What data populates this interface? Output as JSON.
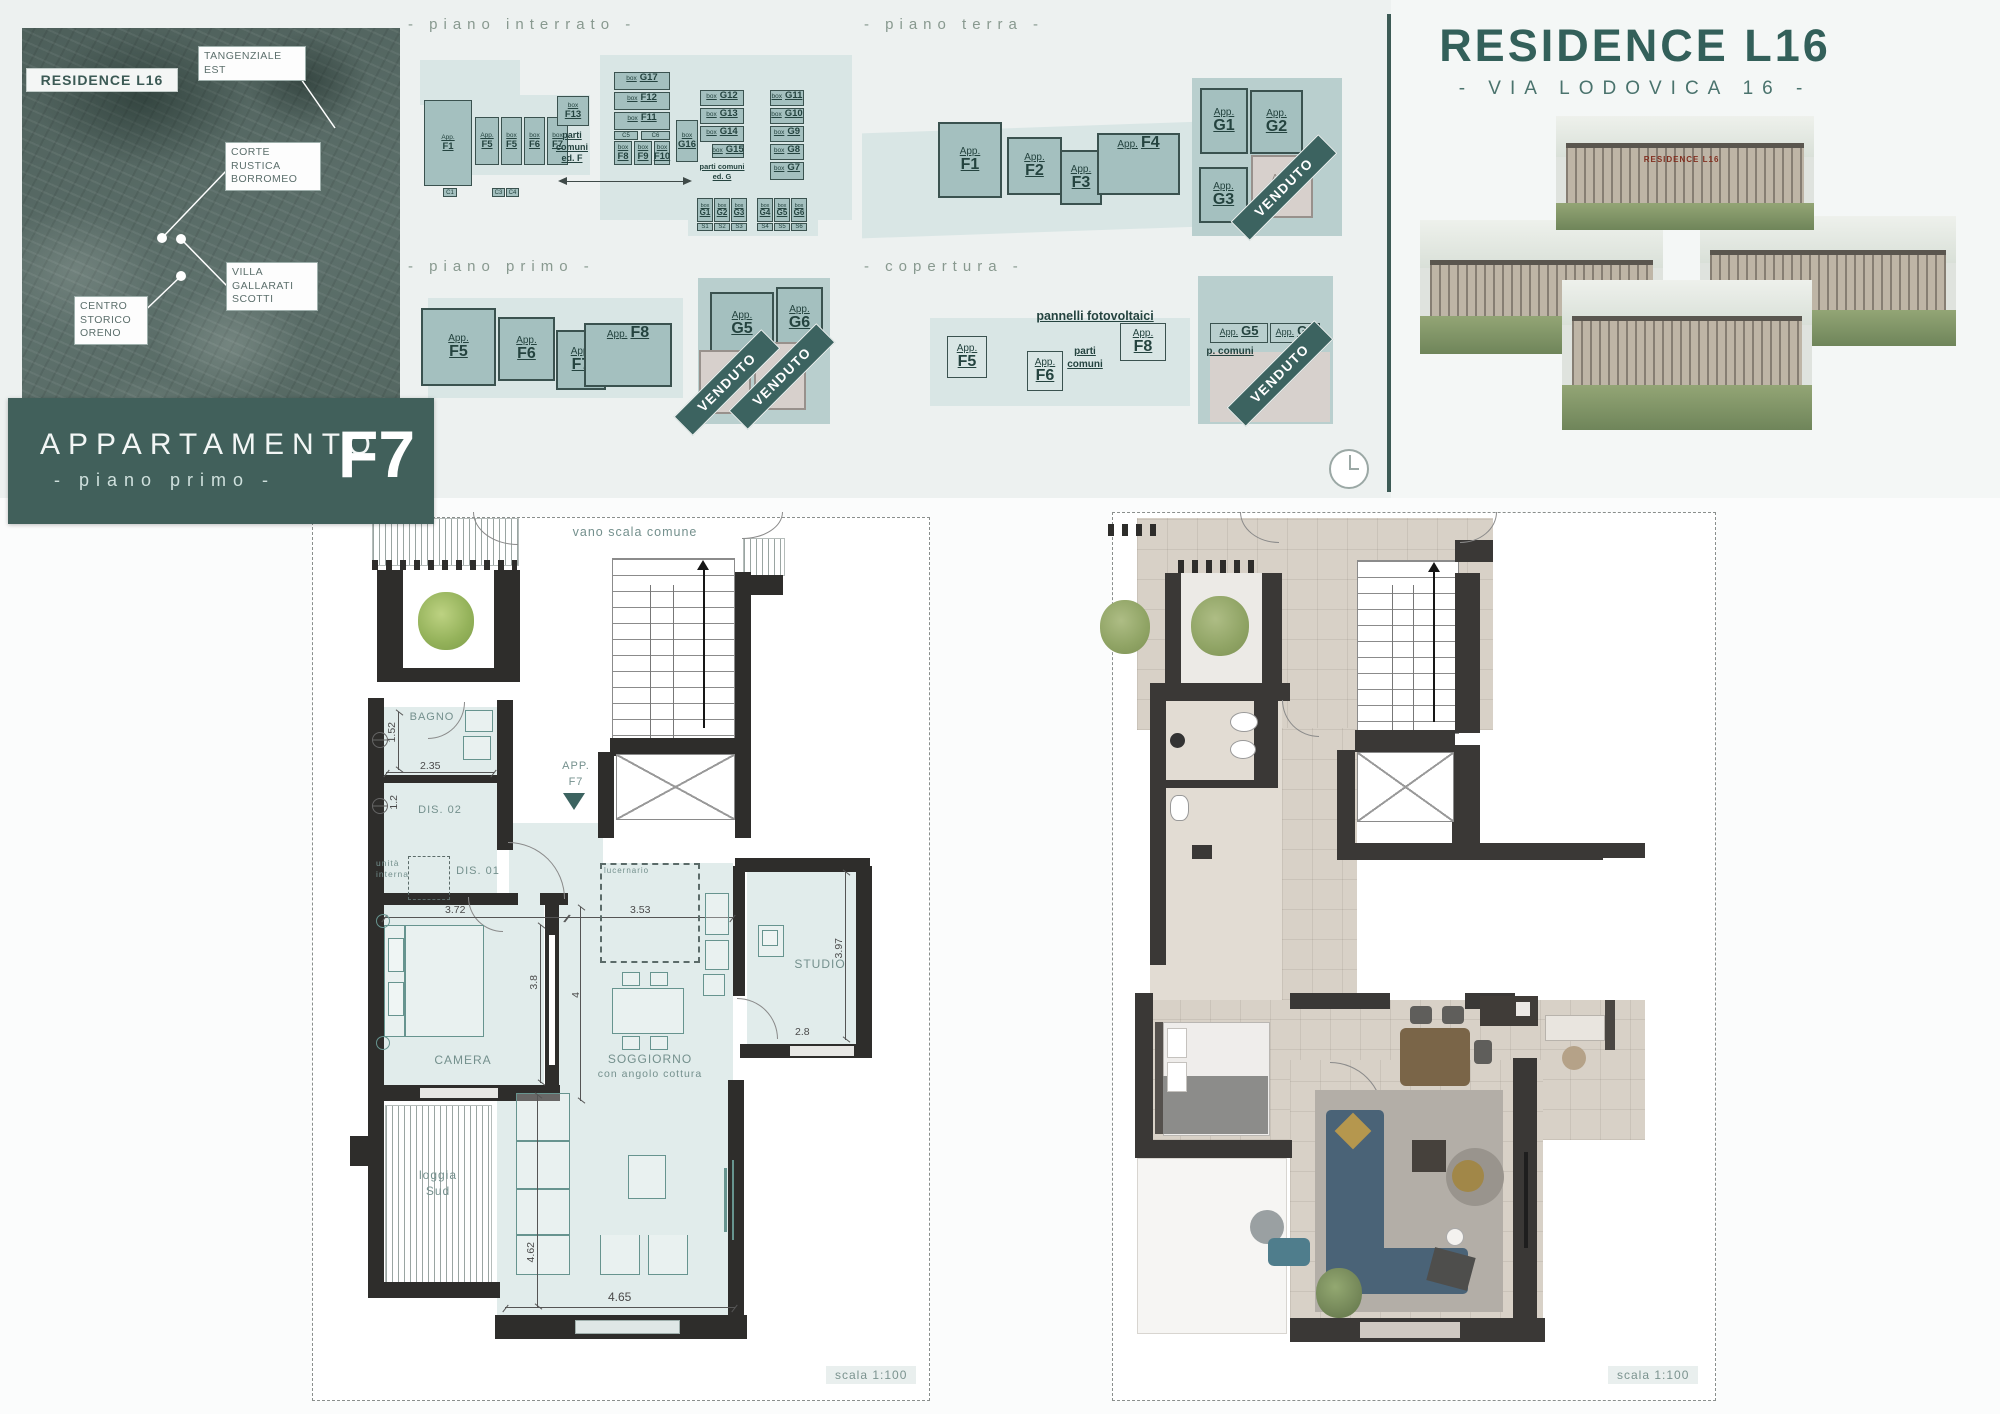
{
  "brand": {
    "title": "RESIDENCE L16",
    "subtitle": "- VIA LODOVICA 16 -",
    "facade_sign": "RESIDENCE L16"
  },
  "map": {
    "logo": "RESIDENCE L16",
    "callouts": [
      "TANGENZIALE\nEST",
      "CORTE\nRUSTICA\nBORROMEO",
      "VILLA\nGALLARATI\nSCOTTI",
      "CENTRO\nSTORICO\nORENO"
    ]
  },
  "title_block": {
    "line1": "APPARTAMENTO",
    "line2": "- piano primo -",
    "unit": "F7"
  },
  "venduto": "VENDUTO",
  "sections": {
    "interrato": "- piano interrato -",
    "terra": "- piano terra -",
    "primo": "- piano primo -",
    "copertura": "- copertura -"
  },
  "interrato": {
    "units": [
      {
        "p": "App.",
        "c": "F1"
      },
      {
        "p": "App.",
        "c": "F5"
      },
      {
        "p": "box",
        "c": "F5"
      },
      {
        "p": "box",
        "c": "F6"
      },
      {
        "p": "box",
        "c": "F7"
      },
      {
        "p": "box",
        "c": "F13"
      },
      {
        "p": "box",
        "c": "G17"
      },
      {
        "p": "box",
        "c": "F12"
      },
      {
        "p": "box",
        "c": "F11"
      },
      {
        "p": "box",
        "c": "F8"
      },
      {
        "p": "box",
        "c": "F9"
      },
      {
        "p": "box",
        "c": "F10"
      },
      {
        "p": "box",
        "c": "G16"
      },
      {
        "p": "box",
        "c": "G12"
      },
      {
        "p": "box",
        "c": "G13"
      },
      {
        "p": "box",
        "c": "G14"
      },
      {
        "p": "box",
        "c": "G15"
      },
      {
        "p": "box",
        "c": "G11"
      },
      {
        "p": "box",
        "c": "G10"
      },
      {
        "p": "box",
        "c": "G9"
      },
      {
        "p": "box",
        "c": "G8"
      },
      {
        "p": "box",
        "c": "G7"
      },
      {
        "p": "box",
        "c": "G1"
      },
      {
        "p": "box",
        "c": "G2"
      },
      {
        "p": "box",
        "c": "G3"
      },
      {
        "p": "box",
        "c": "G4"
      },
      {
        "p": "box",
        "c": "G5"
      },
      {
        "p": "box",
        "c": "G6"
      }
    ],
    "cells": [
      "C1",
      "C3",
      "C4",
      "C5",
      "C6"
    ],
    "scells": [
      "S1",
      "S2",
      "S3",
      "S4",
      "S5",
      "S6"
    ],
    "parti_f": "parti\ncomuni\ned. F",
    "parti_g": "parti comuni\ned. G"
  },
  "terra": {
    "units": [
      {
        "p": "App.",
        "c": "F1"
      },
      {
        "p": "App.",
        "c": "F2"
      },
      {
        "p": "App.",
        "c": "F3"
      },
      {
        "p": "App.",
        "c": "F4"
      },
      {
        "p": "App.",
        "c": "G1"
      },
      {
        "p": "App.",
        "c": "G2"
      },
      {
        "p": "App.",
        "c": "G3"
      },
      {
        "p": "App.",
        "c": "G4"
      }
    ]
  },
  "primo": {
    "units": [
      {
        "p": "App.",
        "c": "F5"
      },
      {
        "p": "App.",
        "c": "F6"
      },
      {
        "p": "App.",
        "c": "F7"
      },
      {
        "p": "App.",
        "c": "F8"
      },
      {
        "p": "App.",
        "c": "G5"
      },
      {
        "p": "App.",
        "c": "G6"
      },
      {
        "p": "App.",
        "c": ""
      },
      {
        "p": "App.",
        "c": ""
      }
    ]
  },
  "copertura": {
    "pannelli": "pannelli fotovoltaici",
    "parti": "parti\ncomuni",
    "p_comuni": "p. comuni",
    "units": [
      {
        "p": "App.",
        "c": "F5"
      },
      {
        "p": "App.",
        "c": "F6"
      },
      {
        "p": "App.",
        "c": "F8"
      },
      {
        "p": "App.",
        "c": "G5"
      },
      {
        "p": "App.",
        "c": "G6"
      }
    ],
    "sold": {
      "p": "App.",
      "c": ""
    }
  },
  "plan_left": {
    "common_label": "vano scala comune",
    "marker": {
      "l1": "APP.",
      "l2": "F7"
    },
    "rooms": {
      "bagno": "BAGNO",
      "dis02": "DIS. 02",
      "dis01": "DIS. 01",
      "unita": "unità\ninterna",
      "lucernario": "lucernario",
      "camera": "CAMERA",
      "sogg1": "SOGGIORNO",
      "sogg2": "con angolo cottura",
      "studio": "STUDIO",
      "loggia": "loggia\nSud"
    },
    "dims": {
      "bagno_h": "1.52",
      "bagno_w": "2.35",
      "dis_h": "1.2",
      "camera_w": "3.72",
      "sogg_w": "3.53",
      "camera_h": "3.8",
      "sogg_h": "4",
      "studio_h": "3.97",
      "studio_w": "2.8",
      "living_h": "4.62",
      "living_w": "4.65"
    },
    "scale": "scala 1:100"
  },
  "plan_right": {
    "scale": "scala 1:100"
  }
}
